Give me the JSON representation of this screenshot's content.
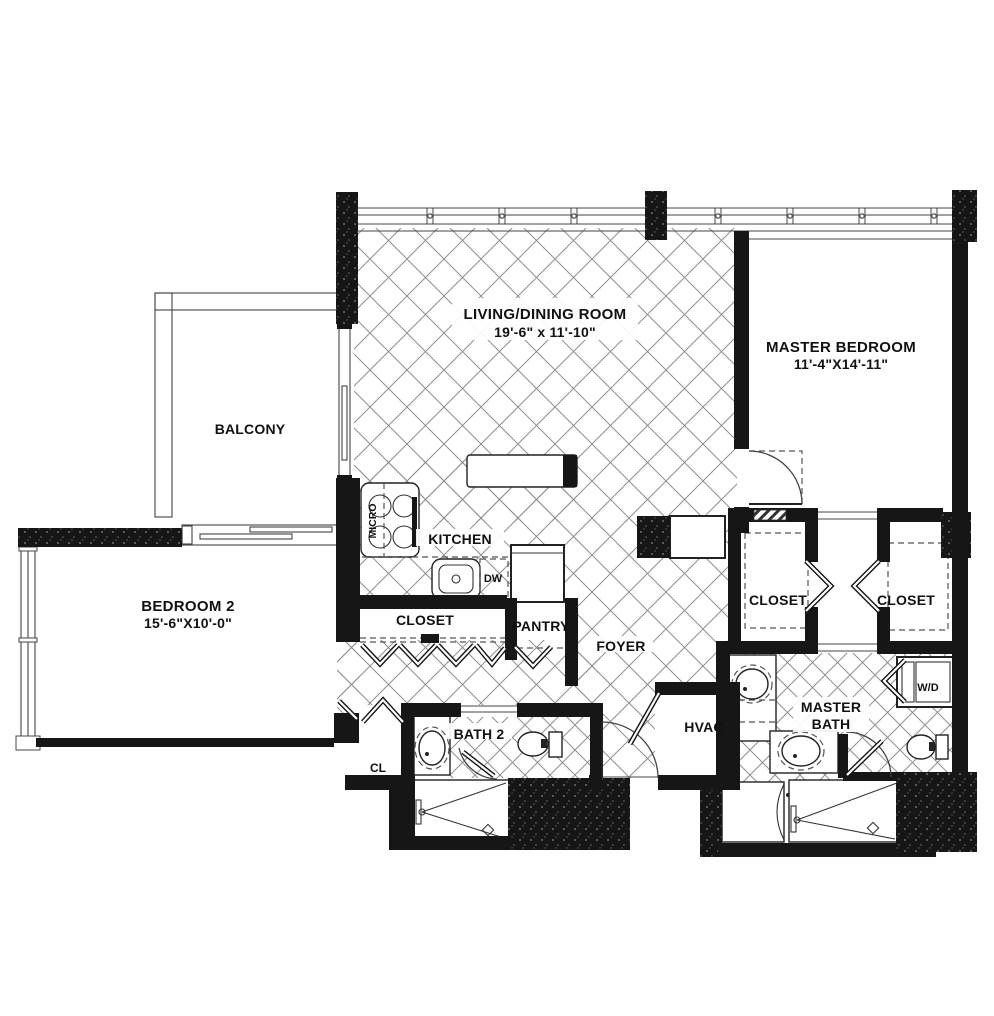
{
  "floorplan": {
    "rooms": {
      "living_dining": {
        "label": "LIVING/DINING ROOM",
        "dimensions": "19'-6\" x 11'-10\""
      },
      "master_bedroom": {
        "label": "MASTER BEDROOM",
        "dimensions": "11'-4\"X14'-11\""
      },
      "balcony": {
        "label": "BALCONY"
      },
      "bedroom2": {
        "label": "BEDROOM 2",
        "dimensions": "15'-6\"X10'-0\""
      },
      "kitchen": {
        "label": "KITCHEN"
      },
      "hall_closet": {
        "label": "CLOSET"
      },
      "pantry": {
        "label": "PANTRY"
      },
      "foyer": {
        "label": "FOYER"
      },
      "master_closet_left": {
        "label": "CLOSET"
      },
      "master_closet_right": {
        "label": "CLOSET"
      },
      "master_bath": {
        "label_line1": "MASTER",
        "label_line2": "BATH"
      },
      "bath2": {
        "label": "BATH 2"
      },
      "hvac": {
        "label": "HVAC"
      },
      "hall_cl": {
        "label": "CL"
      }
    },
    "appliances": {
      "microwave": {
        "label": "MICRO"
      },
      "dishwasher": {
        "label": "DW"
      },
      "washer_dryer": {
        "label": "W/D"
      }
    },
    "colors": {
      "wall": "#161616",
      "floor_line": "#8f8f8f",
      "text": "#111111",
      "background": "#ffffff"
    }
  }
}
